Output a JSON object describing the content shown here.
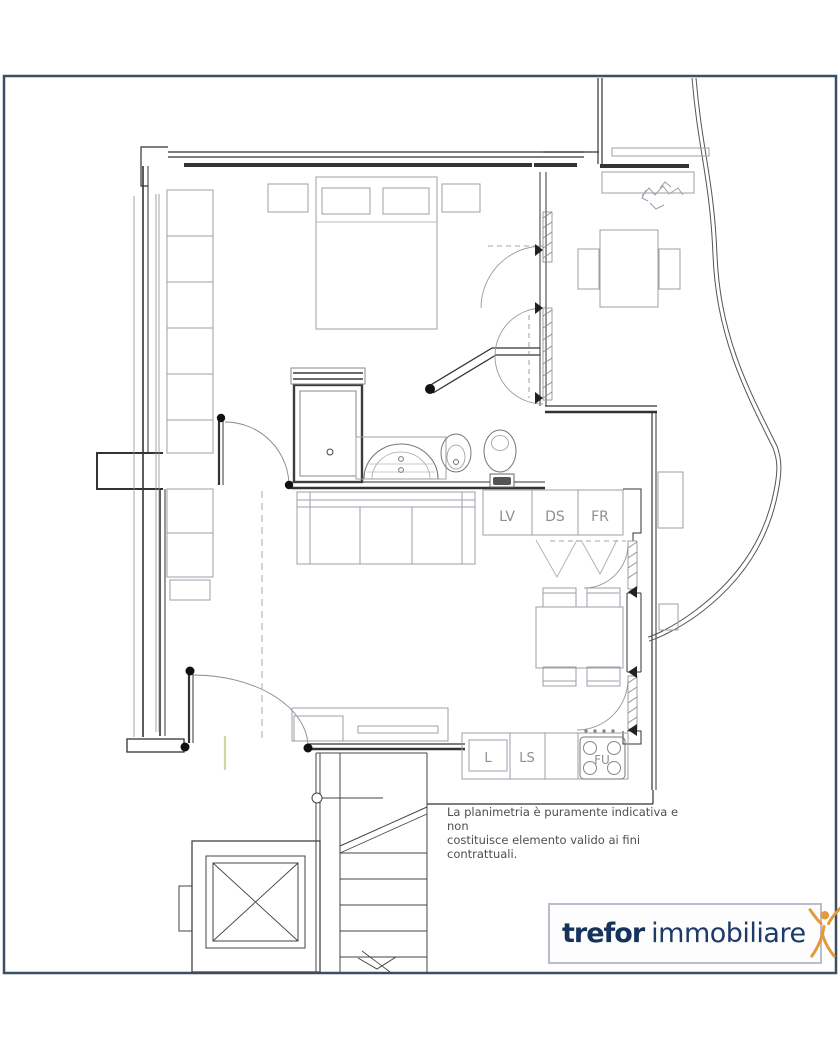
{
  "page": {
    "background": "#ffffff",
    "border_color": "#3d4f63"
  },
  "plan": {
    "counter_labels": {
      "lv": "LV",
      "ds": "DS",
      "fr": "FR",
      "l": "L",
      "ls": "LS",
      "fu": "FU"
    },
    "disclaimer": {
      "line1": "La planimetria è puramente indicativa e non",
      "line2": "costituisce elemento valido ai fini contrattuali.",
      "text_color": "#4e4e4e"
    }
  },
  "logo": {
    "brand_bold": "trefor",
    "brand_regular": "immobiliare",
    "text_color": "#16335e",
    "icon": "person-arms-raised-icon",
    "icon_color": "#e19a3c",
    "border_color": "#b9bfca"
  }
}
